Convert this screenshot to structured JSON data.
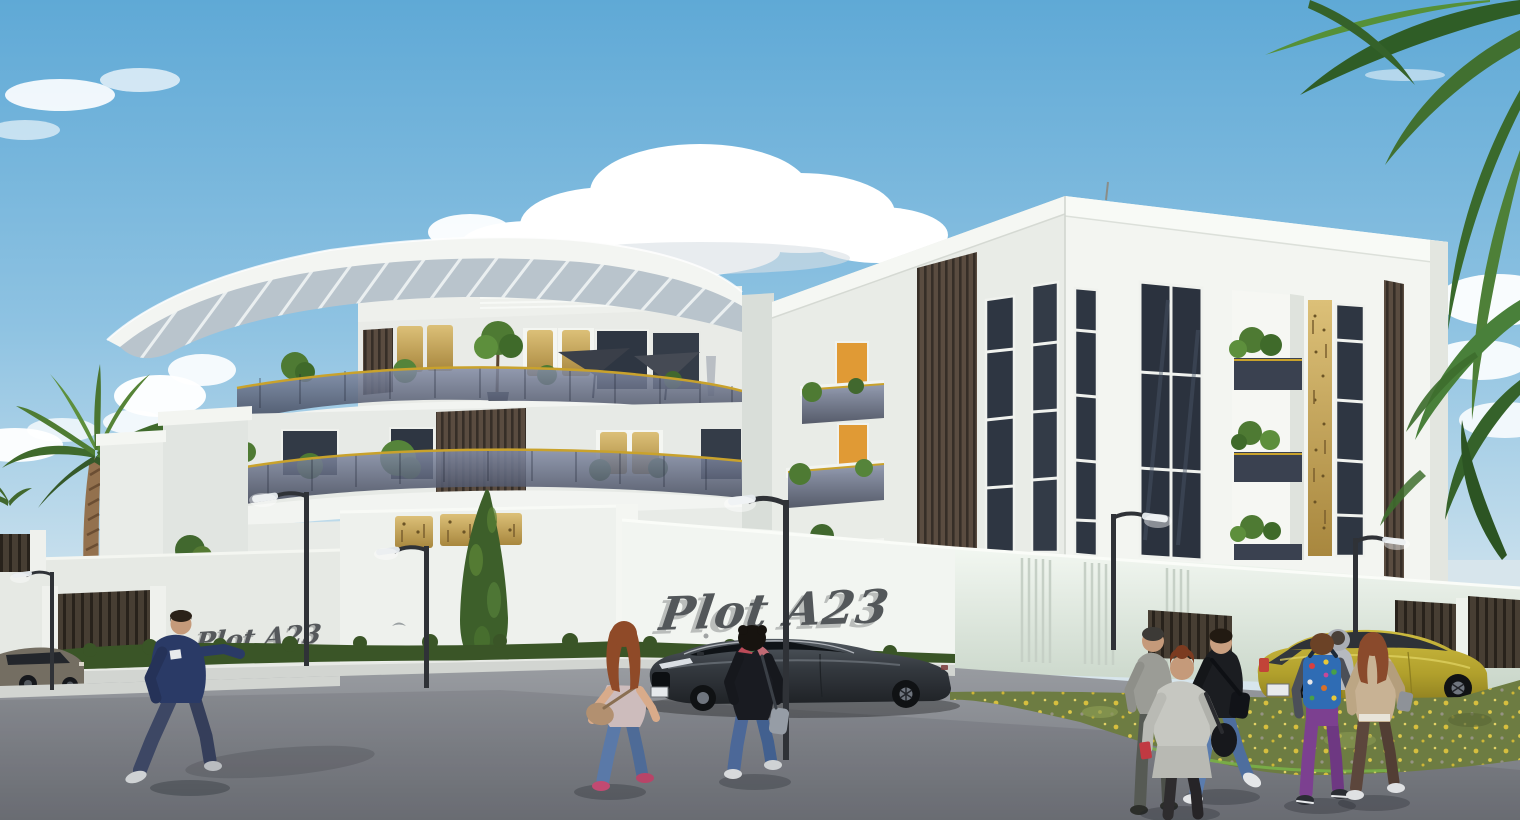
{
  "scene": {
    "signs": {
      "left_wall": "Plot A23",
      "center_wall": "Plot A23"
    },
    "counts": {
      "pedestrians": 9,
      "cars": 3,
      "street_lamps": 6,
      "palm_trees": 2,
      "umbrellas": 2,
      "wall_signs": 2
    },
    "palette": {
      "sky_top": "#5fa9d6",
      "sky_horizon": "#c8dfec",
      "cloud_white": "#ffffff",
      "building_white": "#f2f4f0",
      "building_shadow": "#d8dcd6",
      "wood_slats": "#5a4c40",
      "gold_accent": "#c9a54f",
      "gold_rail": "#c9a22c",
      "glass_balustrade": "#5a6378",
      "window_glass": "#2e3642",
      "door_orange": "#e09a35",
      "hedge_green": "#3a5527",
      "grass_green": "#6d7c42",
      "flower_yellow": "#e3c63e",
      "road_gray": "#84878d",
      "sedan_gray": "#3a4046",
      "hatchback_yellow": "#b5a22e",
      "suv_taupe": "#6e6a60",
      "sign_text_color": "#53575a"
    }
  }
}
